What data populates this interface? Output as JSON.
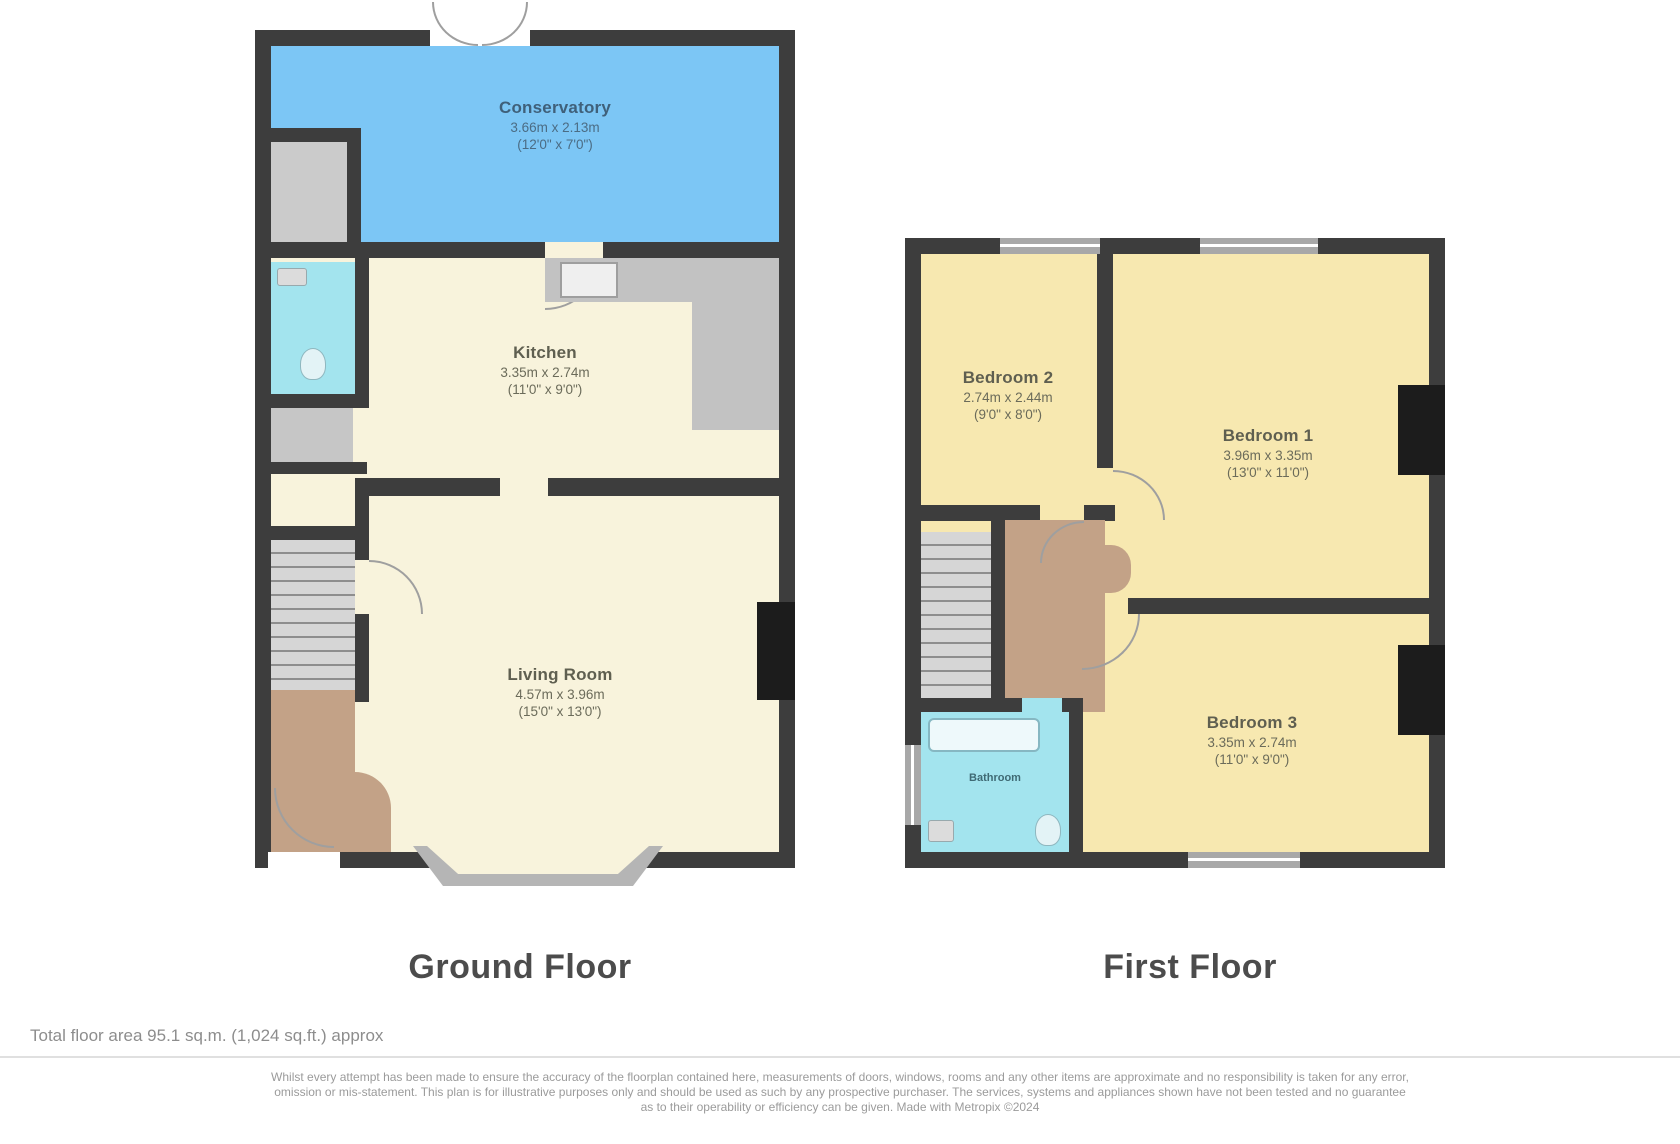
{
  "colors": {
    "wall": "#3d3d3d",
    "cream": "#f8f3dc",
    "yellow": "#f7e8b0",
    "blue": "#7cc6f5",
    "cyan": "#a3e4ee",
    "brown": "#c3a287",
    "caption": "#4c4c4c"
  },
  "ground_floor": {
    "caption": "Ground Floor",
    "conservatory": {
      "name": "Conservatory",
      "dim_metric": "3.66m x 2.13m",
      "dim_imperial": "(12'0\" x 7'0\")"
    },
    "kitchen": {
      "name": "Kitchen",
      "dim_metric": "3.35m x 2.74m",
      "dim_imperial": "(11'0\" x 9'0\")"
    },
    "living_room": {
      "name": "Living Room",
      "dim_metric": "4.57m x 3.96m",
      "dim_imperial": "(15'0\" x 13'0\")"
    }
  },
  "first_floor": {
    "caption": "First Floor",
    "bedroom_2": {
      "name": "Bedroom 2",
      "dim_metric": "2.74m x 2.44m",
      "dim_imperial": "(9'0\" x 8'0\")"
    },
    "bedroom_1": {
      "name": "Bedroom 1",
      "dim_metric": "3.96m x 3.35m",
      "dim_imperial": "(13'0\" x 11'0\")"
    },
    "bedroom_3": {
      "name": "Bedroom 3",
      "dim_metric": "3.35m x 2.74m",
      "dim_imperial": "(11'0\" x 9'0\")"
    },
    "bathroom": {
      "name": "Bathroom"
    }
  },
  "footer": {
    "total_area": "Total floor area 95.1 sq.m. (1,024 sq.ft.) approx",
    "disclaimer": [
      "Whilst every attempt has been made to ensure the accuracy of the floorplan contained here, measurements of doors, windows, rooms and any other items are approximate and no responsibility is taken for any error,",
      "omission or mis-statement. This plan is for illustrative purposes only and should be used as such by any prospective purchaser. The services, systems and appliances shown have not been tested and no guarantee",
      "as to their operability or efficiency can be given. Made with Metropix ©2024"
    ]
  }
}
